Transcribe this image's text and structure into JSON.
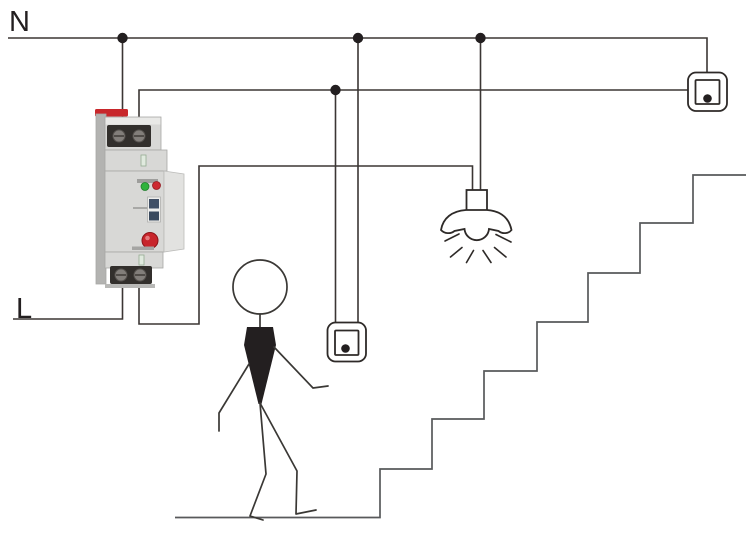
{
  "canvas": {
    "width": 750,
    "height": 535,
    "background": "#ffffff"
  },
  "labels": {
    "neutral": "N",
    "line": "L"
  },
  "colors": {
    "ink": "#231f20",
    "wire": "#3b3634",
    "symbol": "#2e2a28",
    "stairs": "#58595b",
    "person": "#3a3835",
    "junction": "#231f20",
    "device_body": "#d8d8d6",
    "device_side": "#b3b3b1",
    "device_terminal": "#322f2c",
    "clip_red": "#c8272b",
    "led_green": "#2fb23c",
    "led_red": "#cd2931",
    "button_red": "#c8252b",
    "slider_blue": "#415066"
  },
  "components": {
    "timer_relay_icon": "din-rail-staircase-timer-relay",
    "push_button_icons": [
      "push-button-middle",
      "push-button-top-right"
    ],
    "lamp_icon": "pendant-lamp-with-rays",
    "person_icon": "walking-stick-figure",
    "stairs_icon": "staircase-7-steps",
    "junction_dots": 4
  }
}
